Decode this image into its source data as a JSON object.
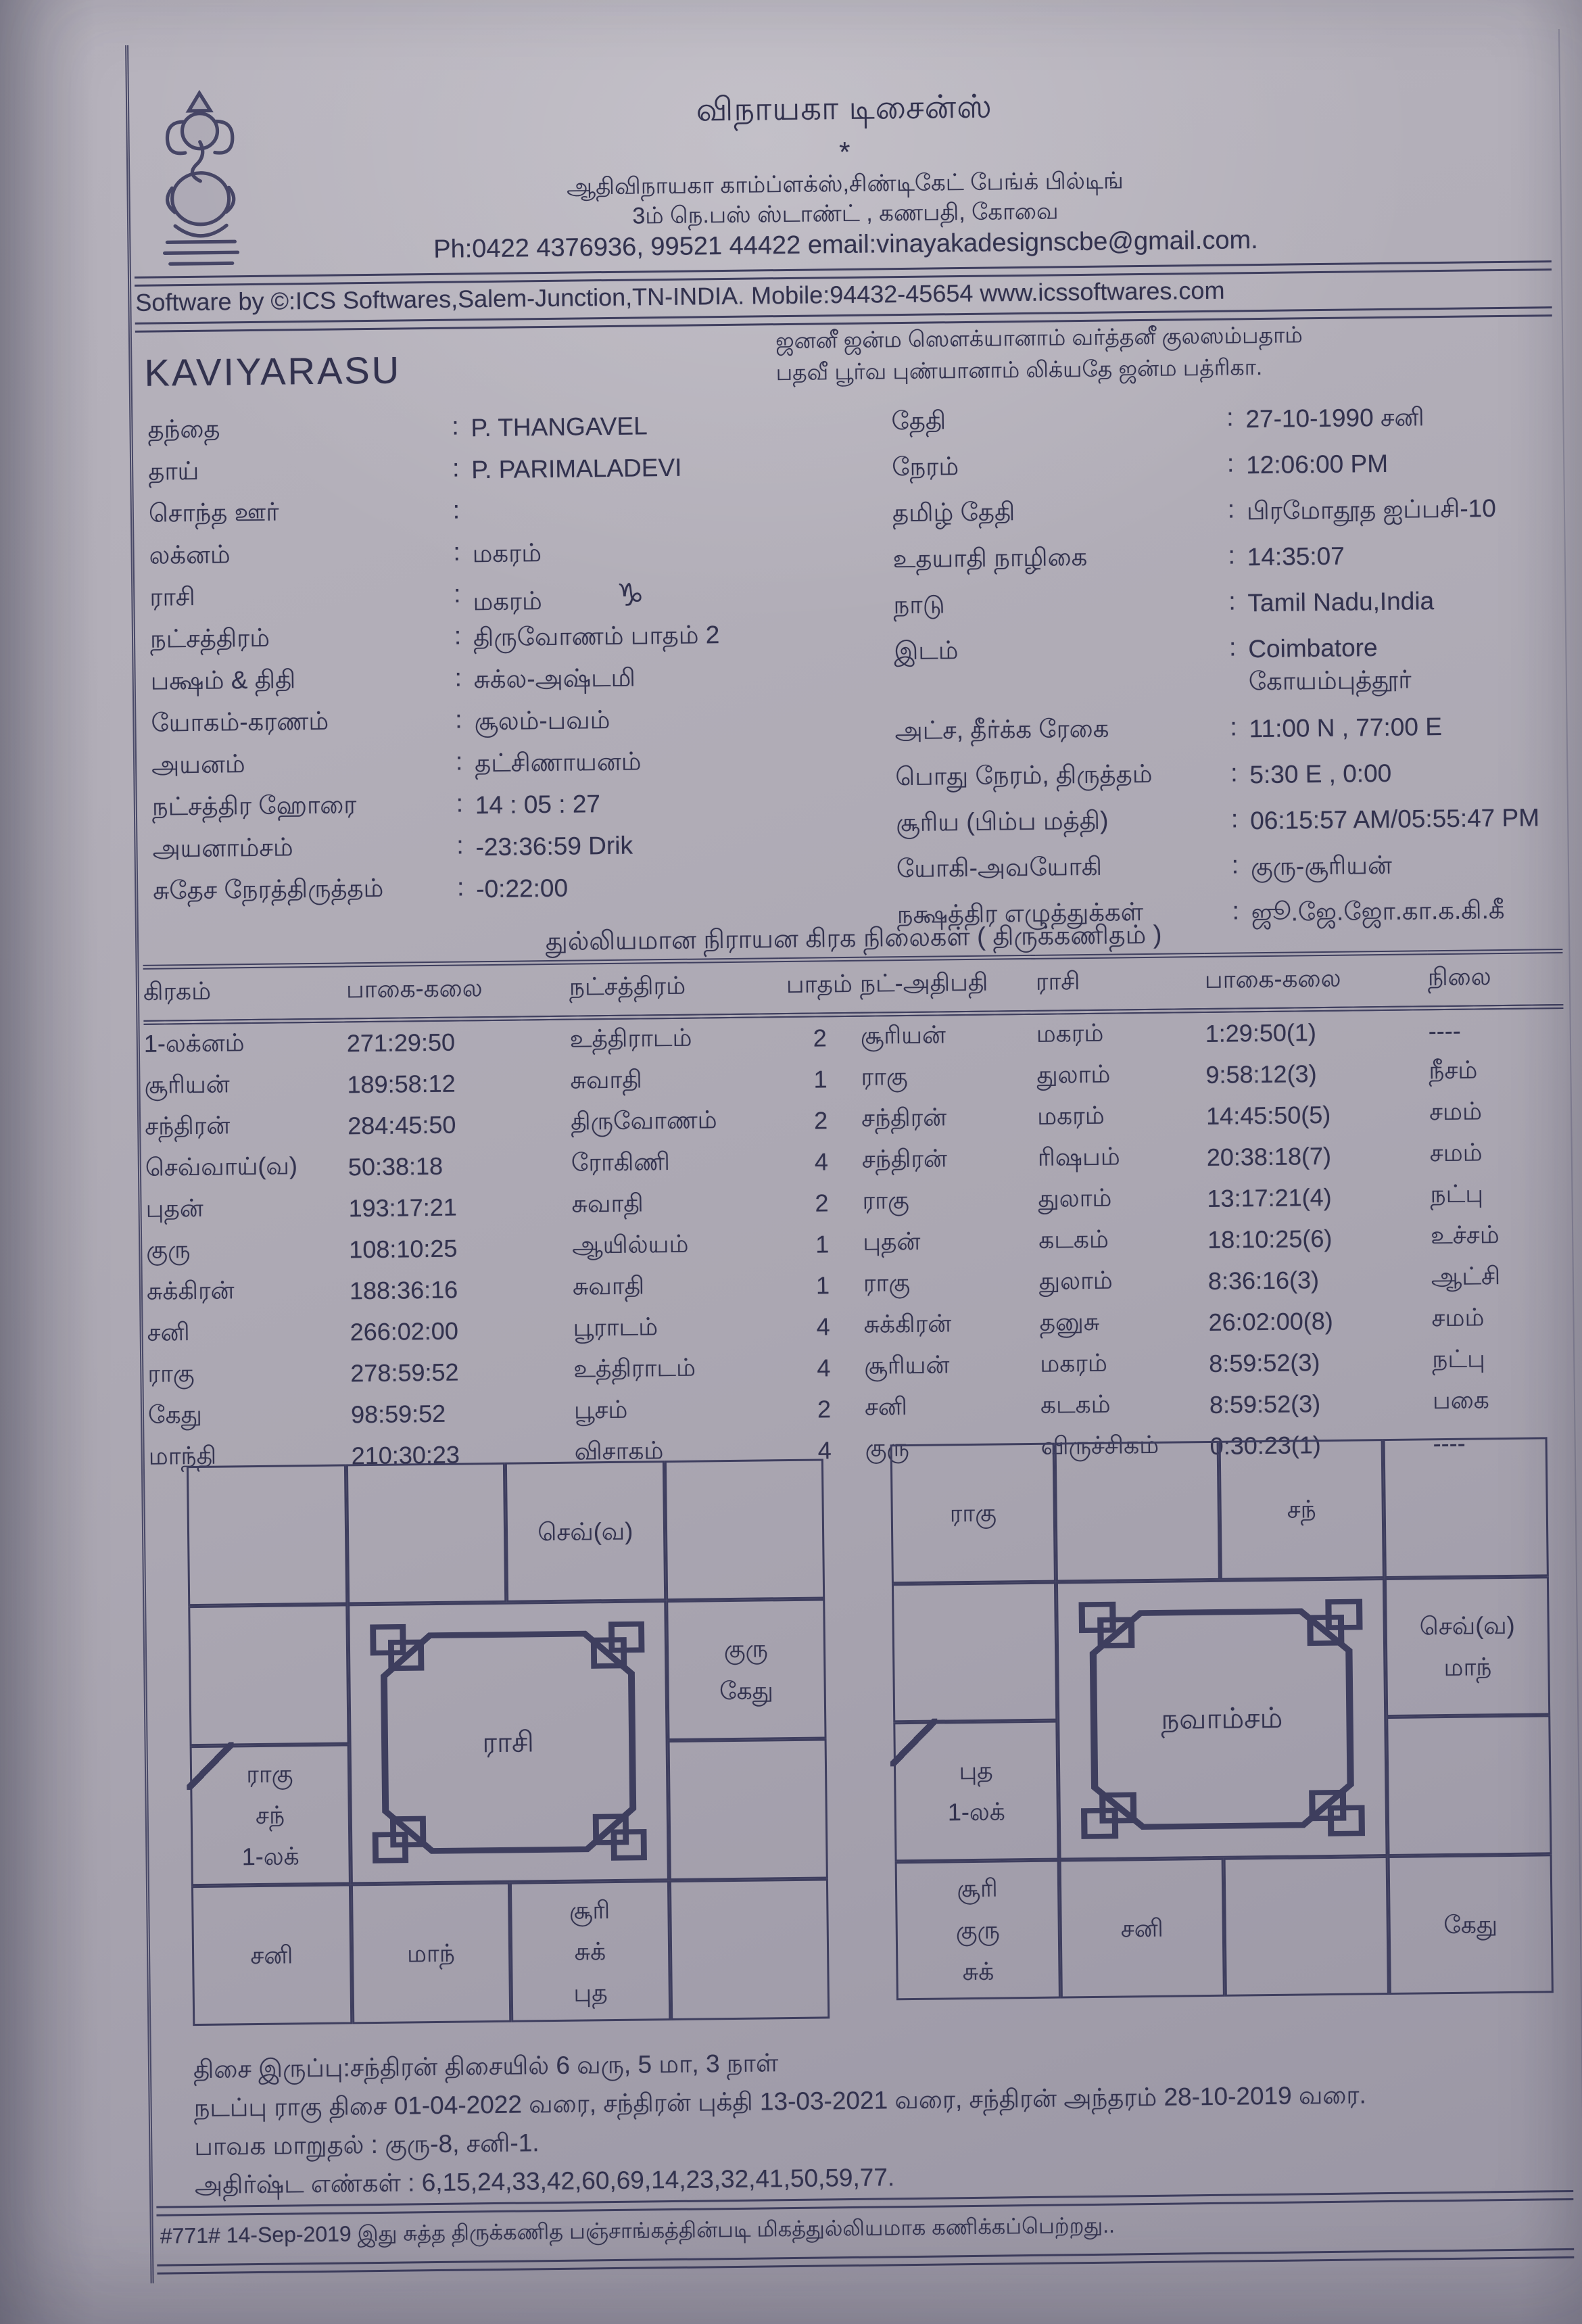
{
  "punct": {
    "colon": ":"
  },
  "colors": {
    "paper": "#aca8b2",
    "ink": "#32324e",
    "line": "#3e3e5e"
  },
  "header": {
    "business_name": "விநாயகா டிசைன்ஸ்",
    "star": "*",
    "address_line1": "ஆதிவிநாயகா காம்ப்ளக்ஸ்,சிண்டிகேட் பேங்க் பில்டிங்",
    "address_line2": "3ம் நெ.பஸ் ஸ்டாண்ட் , கணபதி, கோவை",
    "contact_line": "Ph:0422 4376936, 99521 44422 email:vinayakadesignscbe@gmail.com.",
    "software_line": "Software by ©:ICS Softwares,Salem-Junction,TN-INDIA. Mobile:94432-45654 www.icssoftwares.com"
  },
  "blessing": {
    "line1": "ஜனனீ ஜன்ம ஸௌக்யானாம் வர்த்தனீ குலஸம்பதாம்",
    "line2": "பதவீ பூர்வ புண்யானாம் லிக்யதே ஜன்ம பத்ரிகா."
  },
  "person": {
    "name": "KAVIYARASU",
    "capricorn_symbol": "♑"
  },
  "details_left": [
    {
      "label": "தந்தை",
      "value": "P. THANGAVEL"
    },
    {
      "label": "தாய்",
      "value": "P. PARIMALADEVI"
    },
    {
      "label": "சொந்த ஊர்",
      "value": ""
    },
    {
      "label": "லக்னம்",
      "value": "மகரம்"
    },
    {
      "label": "ராசி",
      "value": "மகரம்"
    },
    {
      "label": "நட்சத்திரம்",
      "value": "திருவோணம் பாதம்  2"
    },
    {
      "label": "பக்ஷம் & திதி",
      "value": "சுக்ல-அஷ்டமி"
    },
    {
      "label": "யோகம்-கரணம்",
      "value": "சூலம்-பவம்"
    },
    {
      "label": "அயனம்",
      "value": "தட்சிணாயனம்"
    },
    {
      "label": "நட்சத்திர ஹோரை",
      "value": "14 : 05 : 27"
    },
    {
      "label": "அயனாம்சம்",
      "value": "-23:36:59 Drik"
    },
    {
      "label": "சுதேச நேரத்திருத்தம்",
      "value": "-0:22:00"
    }
  ],
  "details_right": [
    {
      "label": "தேதி",
      "value": "27-10-1990 சனி"
    },
    {
      "label": "நேரம்",
      "value": "12:06:00 PM"
    },
    {
      "label": "தமிழ் தேதி",
      "value": "பிரமோதூத ஐப்பசி-10"
    },
    {
      "label": "உதயாதி நாழிகை",
      "value": "14:35:07"
    },
    {
      "label": "நாடு",
      "value": "Tamil Nadu,India"
    },
    {
      "label": "இடம்",
      "value": "Coimbatore\nகோயம்புத்தூர்"
    },
    {
      "label": "அட்ச, தீர்க்க ரேகை",
      "value": "11:00 N , 77:00 E"
    },
    {
      "label": "பொது நேரம், திருத்தம்",
      "value": "5:30 E , 0:00"
    },
    {
      "label": "சூரிய (பிம்ப மத்தி)",
      "value": "06:15:57 AM/05:55:47 PM"
    },
    {
      "label": "யோகி-அவயோகி",
      "value": "குரு-சூரியன்"
    },
    {
      "label": "நக்ஷத்திர எழுத்துக்கள்",
      "value": "ஜூ.ஜே.ஜோ.கா.க.கி.கீ"
    }
  ],
  "table": {
    "title": "துல்லியமான நிராயன கிரக நிலைகள் ( திருக்கணிதம் )",
    "headers": [
      "கிரகம்",
      "பாகை-கலை",
      "நட்சத்திரம்",
      "பாதம்",
      "நட்-அதிபதி",
      "ராசி",
      "பாகை-கலை",
      "நிலை"
    ],
    "rows": [
      [
        "1-லக்னம்",
        "271:29:50",
        "உத்திராடம்",
        "2",
        "சூரியன்",
        "மகரம்",
        "1:29:50(1)",
        "----"
      ],
      [
        "சூரியன்",
        "189:58:12",
        "சுவாதி",
        "1",
        "ராகு",
        "துலாம்",
        "9:58:12(3)",
        "நீசம்"
      ],
      [
        "சந்திரன்",
        "284:45:50",
        "திருவோணம்",
        "2",
        "சந்திரன்",
        "மகரம்",
        "14:45:50(5)",
        "சமம்"
      ],
      [
        "செவ்வாய்(வ)",
        "50:38:18",
        "ரோகிணி",
        "4",
        "சந்திரன்",
        "ரிஷபம்",
        "20:38:18(7)",
        "சமம்"
      ],
      [
        "புதன்",
        "193:17:21",
        "சுவாதி",
        "2",
        "ராகு",
        "துலாம்",
        "13:17:21(4)",
        "நட்பு"
      ],
      [
        "குரு",
        "108:10:25",
        "ஆயில்யம்",
        "1",
        "புதன்",
        "கடகம்",
        "18:10:25(6)",
        "உச்சம்"
      ],
      [
        "சுக்கிரன்",
        "188:36:16",
        "சுவாதி",
        "1",
        "ராகு",
        "துலாம்",
        "8:36:16(3)",
        "ஆட்சி"
      ],
      [
        "சனி",
        "266:02:00",
        "பூராடம்",
        "4",
        "சுக்கிரன்",
        "தனுசு",
        "26:02:00(8)",
        "சமம்"
      ],
      [
        "ராகு",
        "278:59:52",
        "உத்திராடம்",
        "4",
        "சூரியன்",
        "மகரம்",
        "8:59:52(3)",
        "நட்பு"
      ],
      [
        "கேது",
        "98:59:52",
        "பூசம்",
        "2",
        "சனி",
        "கடகம்",
        "8:59:52(3)",
        "பகை"
      ],
      [
        "மாந்தி",
        "210:30:23",
        "விசாகம்",
        "4",
        "குரு",
        "விருச்சிகம்",
        "0:30:23(1)",
        "----"
      ]
    ]
  },
  "charts": {
    "rasi": {
      "title": "ராசி",
      "cells": [
        "",
        "",
        "செவ்(வ)",
        "",
        "",
        "குரு\nகேது",
        "ராகு\nசந்\n1-லக்",
        "",
        "சனி",
        "மாந்",
        "சூரி\nசுக்\nபுத",
        ""
      ]
    },
    "navamsam": {
      "title": "நவாம்சம்",
      "cells": [
        "ராகு",
        "",
        "சந்",
        "",
        "",
        "செவ்(வ)\nமாந்",
        "புத\n1-லக்",
        "",
        "சூரி\nகுரு\nசுக்",
        "சனி",
        "",
        "கேது"
      ]
    }
  },
  "footer": {
    "line1": "திசை இருப்பு:சந்திரன் திசையில் 6 வரு, 5 மா, 3 நாள்",
    "line2": "நடப்பு ராகு திசை 01-04-2022 வரை, சந்திரன் புக்தி 13-03-2021 வரை, சந்திரன் அந்தரம் 28-10-2019 வரை.",
    "line3": "பாவக மாறுதல் : குரு-8, சனி-1.",
    "line4": "அதிர்ஷ்ட எண்கள் : 6,15,24,33,42,60,69,14,23,32,41,50,59,77."
  },
  "bottom_note": "#771# 14-Sep-2019 இது சுத்த திருக்கணித பஞ்சாங்கத்தின்படி மிகத்துல்லியமாக கணிக்கப்பெற்றது.."
}
